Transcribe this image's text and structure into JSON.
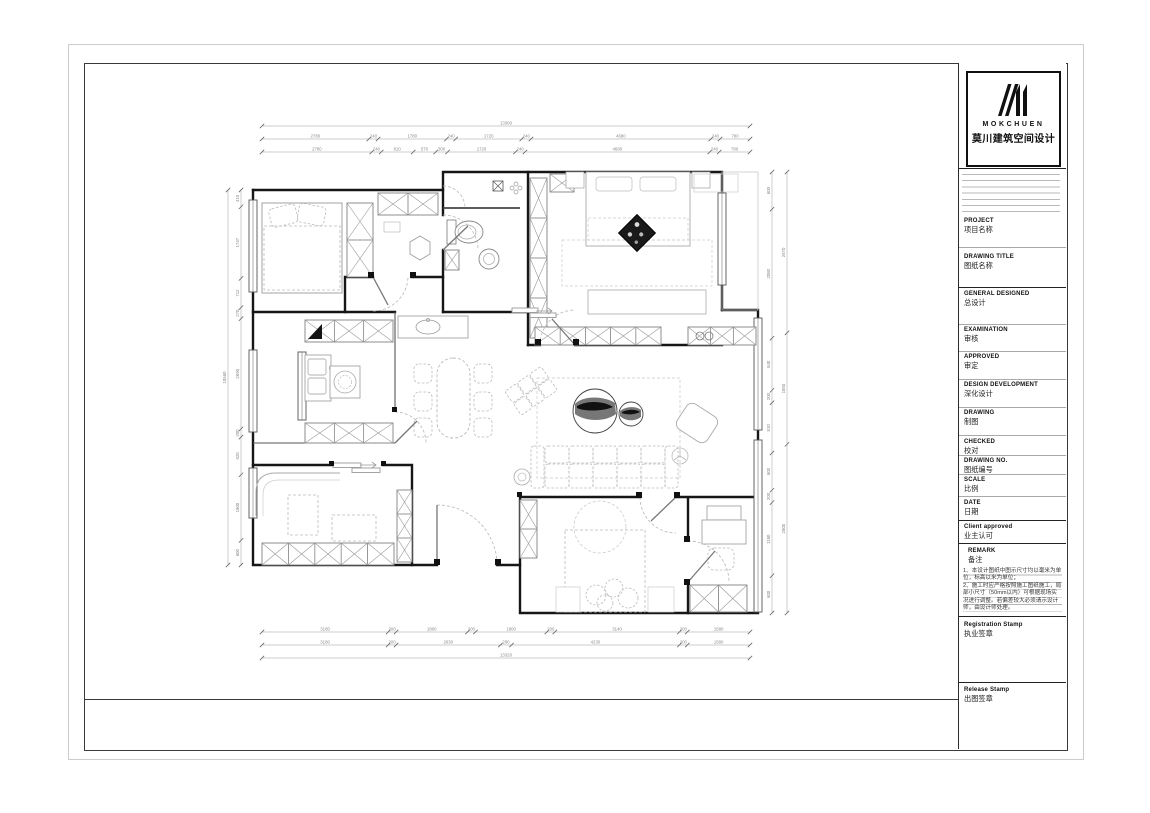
{
  "page": {
    "background": "#ffffff",
    "sheet_border_color": "#cccccc",
    "frame_color": "#3a3a3a"
  },
  "title_block": {
    "logo": {
      "brand": "MOKCHUEN",
      "brand_cn": "莫川建筑空间设计"
    },
    "fields": [
      {
        "en": "PROJECT",
        "cn": "项目名称"
      },
      {
        "en": "DRAWING TITLE",
        "cn": "图纸名称"
      },
      {
        "en": "GENERAL  DESIGNED",
        "cn": "总设计"
      },
      {
        "en": "EXAMINATION",
        "cn": "审核"
      },
      {
        "en": "APPROVED",
        "cn": "审定"
      },
      {
        "en": "DESIGN DEVELOPMENT",
        "cn": "深化设计"
      },
      {
        "en": "DRAWING",
        "cn": "制图"
      },
      {
        "en": "CHECKED",
        "cn": "校对"
      },
      {
        "en": "DRAWING NO.",
        "cn": "图纸编号"
      },
      {
        "en": "SCALE",
        "cn": "比例"
      },
      {
        "en": "DATE",
        "cn": "日期"
      },
      {
        "en": "Client approved",
        "cn": "业主认可"
      }
    ],
    "remark": {
      "en": "REMARK",
      "cn": "备注",
      "items": [
        "1、本设计图纸中图示尺寸均以毫米为单位，标高以米为单位；",
        "2、施工时应严格按照施工图纸施工，局部小尺寸（50mm以内）可根据现场实况进行调整。若偏差较大必须请示设计师，由设计师处理。"
      ]
    },
    "stamps": [
      {
        "en": "Registration Stamp",
        "cn": "执业签章"
      },
      {
        "en": "Release Stamp",
        "cn": "出图签章"
      }
    ]
  },
  "plan": {
    "dimensions": {
      "top_overall": [
        "13300"
      ],
      "top_row1": [
        "2780",
        "240",
        "1780",
        "240",
        "1720",
        "240",
        "4680",
        "240",
        "780"
      ],
      "top_row2": [
        "2780",
        "240",
        "810",
        "570",
        "300",
        "1720",
        "240",
        "4680",
        "240",
        "780"
      ],
      "bottom_row1": [
        "3180",
        "200",
        "1800",
        "200",
        "1800",
        "200",
        "3140",
        "200",
        "1580"
      ],
      "bottom_row2": [
        "3180",
        "200",
        "2630",
        "280",
        "4230",
        "200",
        "1580"
      ],
      "bottom_overall": [
        "13320"
      ],
      "left_row1": [
        "410",
        "1747",
        "712",
        "270",
        "2690",
        "200",
        "920",
        "1600",
        "600"
      ],
      "left_overall": [
        "10560"
      ],
      "right_row1": [
        "600",
        "2080",
        "840",
        "200",
        "810",
        "600",
        "200",
        "1180",
        "600"
      ],
      "right_row2": [
        "2670",
        "1850",
        "2800"
      ]
    }
  }
}
